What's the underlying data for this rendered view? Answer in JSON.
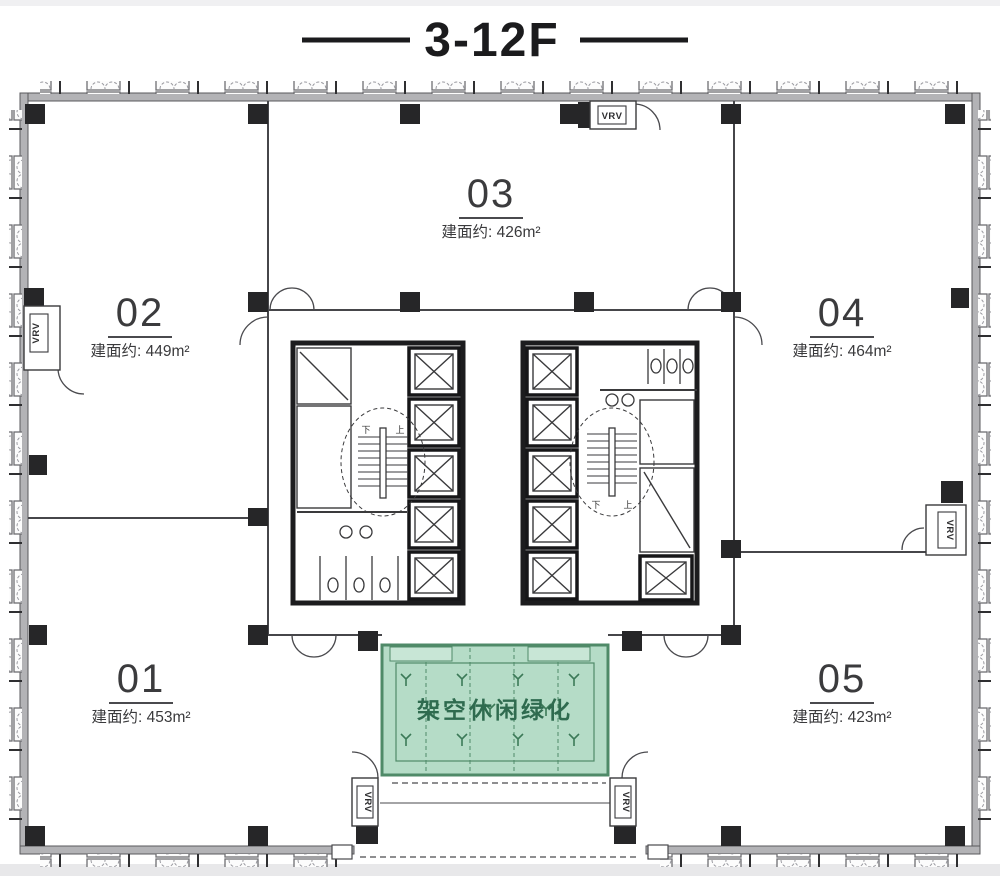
{
  "title": "3-12F",
  "units": [
    {
      "number": "01",
      "area": "建面约: 453m²"
    },
    {
      "number": "02",
      "area": "建面约: 449m²"
    },
    {
      "number": "03",
      "area": "建面约: 426m²"
    },
    {
      "number": "04",
      "area": "建面约: 464m²"
    },
    {
      "number": "05",
      "area": "建面约: 423m²"
    }
  ],
  "green_area": {
    "label": "架空休闲绿化"
  },
  "hvac_label": "VRV",
  "stair_labels": {
    "down": "下",
    "up": "上"
  },
  "colors": {
    "green_fill": "#b5dcc7",
    "green_border": "#4f8a68",
    "green_text": "#2f6b4f",
    "wall_gray": "#b3b3b6",
    "column_black": "#262628",
    "line_dark": "#3f3f43"
  }
}
